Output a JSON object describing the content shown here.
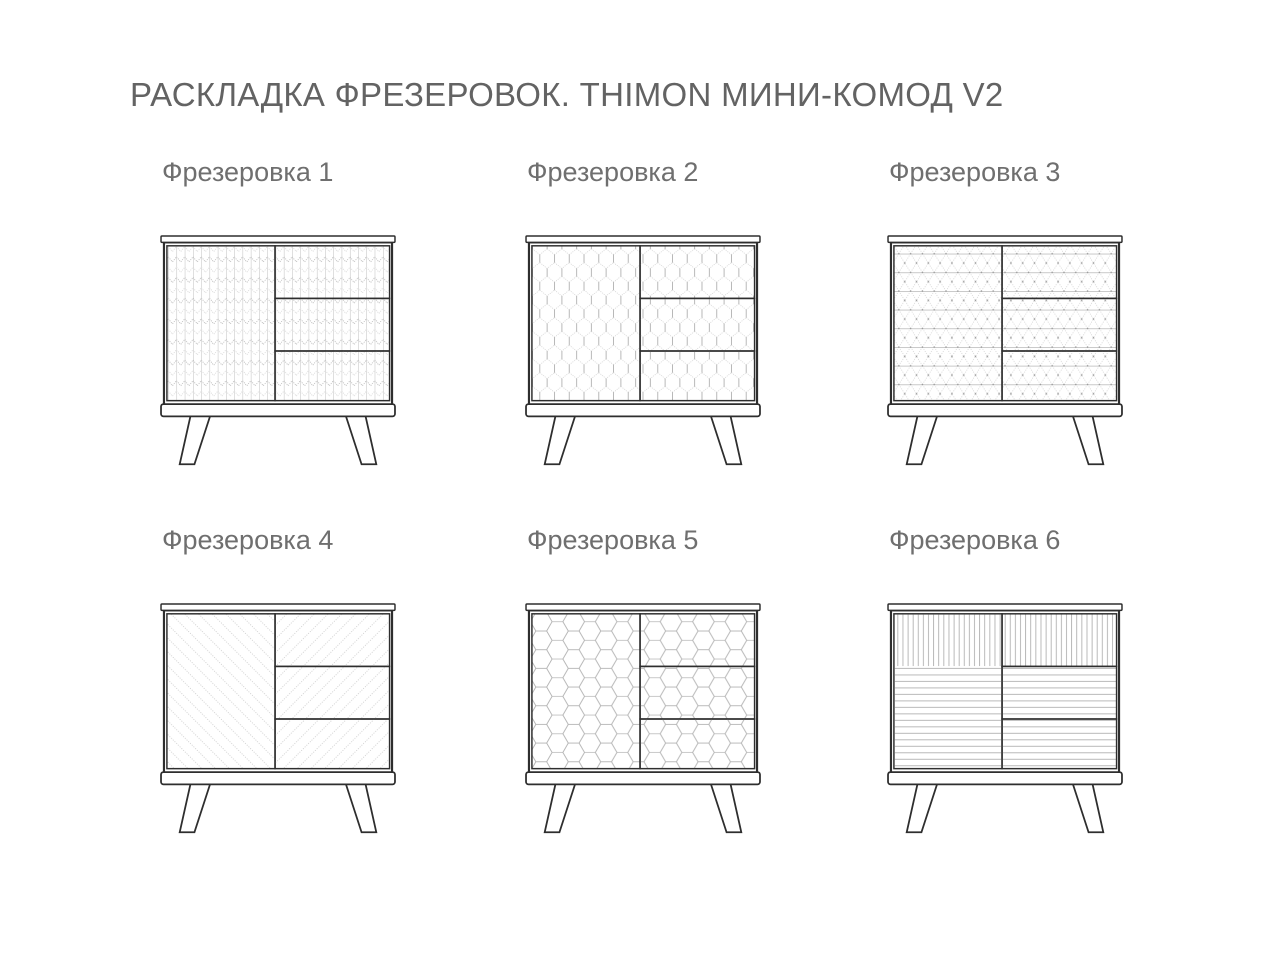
{
  "title": "РАСКЛАДКА ФРЕЗЕРОВОК. THIMON МИНИ-КОМОД V2",
  "product": "THIMON МИНИ-КОМОД V2",
  "variants": [
    {
      "label": "Фрезеровка 1",
      "pattern": "herringbone-chevron"
    },
    {
      "label": "Фрезеровка 2",
      "pattern": "small-honeycomb-pointy-top"
    },
    {
      "label": "Фрезеровка 3",
      "pattern": "rhombic-cube-lattice"
    },
    {
      "label": "Фрезеровка 4",
      "pattern": "diagonal-lines"
    },
    {
      "label": "Фрезеровка 5",
      "pattern": "large-honeycomb-flat-top"
    },
    {
      "label": "Фрезеровка 6",
      "pattern": "vertical-stripes-top-horizontal-stripes-bottom"
    }
  ],
  "colors": {
    "background": "#ffffff",
    "title_text": "#636363",
    "label_text": "#6f6f6f",
    "outline": "#2e2e2e",
    "pattern_line": "#a5a5a5",
    "pattern_line_light": "#c9c9c9"
  }
}
